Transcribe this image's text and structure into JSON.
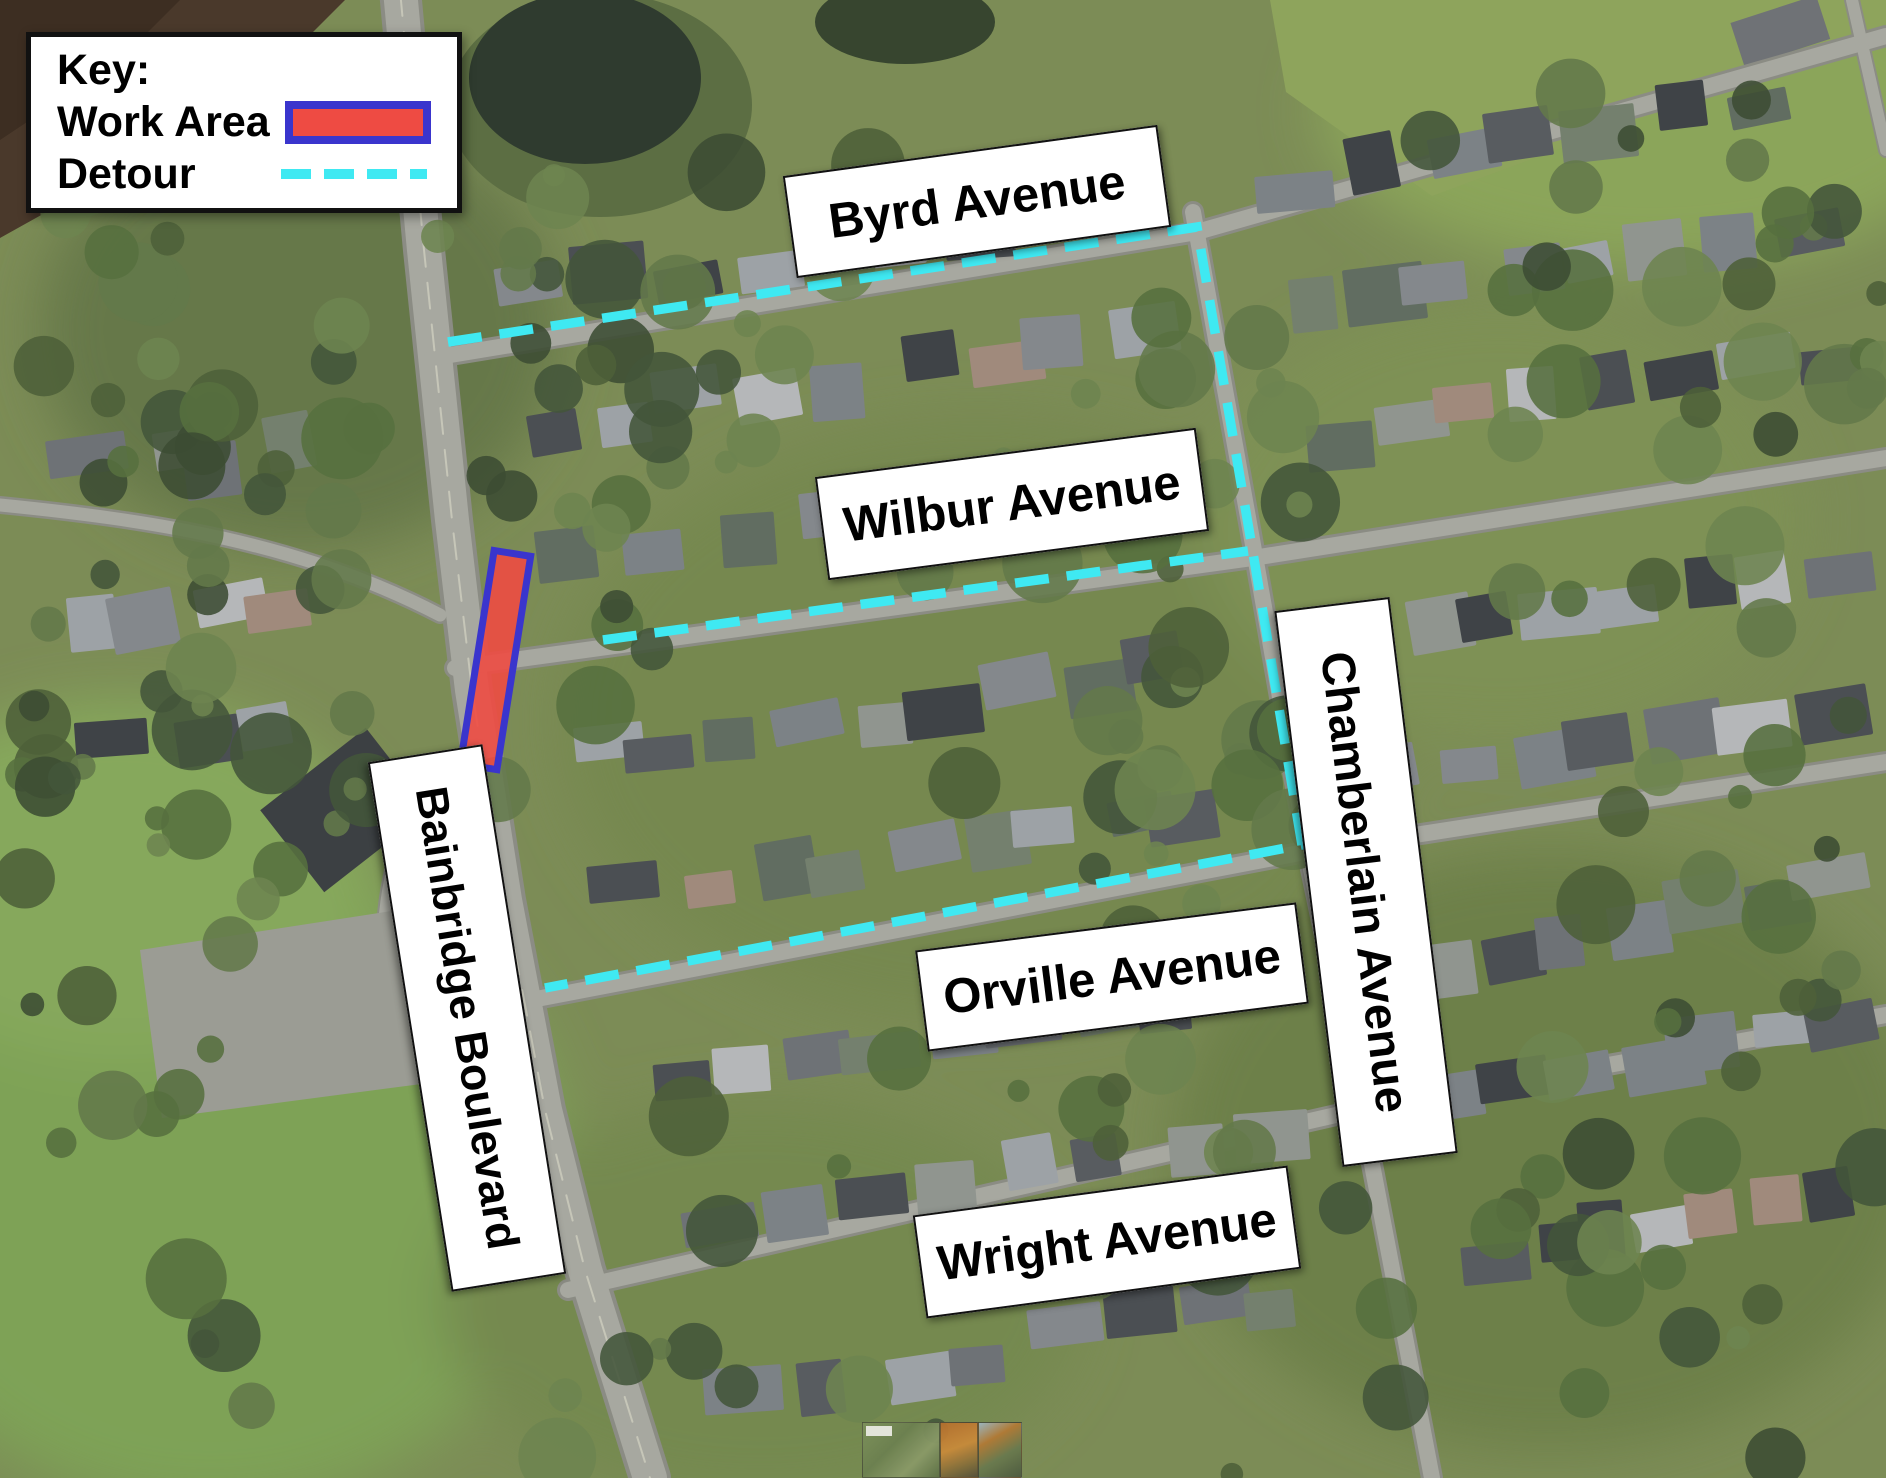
{
  "legend": {
    "title": "Key:",
    "items": [
      {
        "label": "Work Area",
        "swatch": "work-area-swatch"
      },
      {
        "label": "Detour",
        "swatch": "detour-swatch"
      }
    ]
  },
  "streets": {
    "byrd": "Byrd Avenue",
    "wilbur": "Wilbur Avenue",
    "orville": "Orville Avenue",
    "wright": "Wright Avenue",
    "chamberlain": "Chamberlain Avenue",
    "bainbridge": "Bainbridge Boulevard"
  },
  "colors": {
    "work_area_fill": "#ee4b43",
    "work_area_border": "#3a35cd",
    "detour": "#3fe9f2",
    "label_bg": "#ffffff",
    "label_border": "#111111",
    "label_text": "#000000",
    "legend_bg": "#ffffff",
    "legend_border": "#111111"
  },
  "overlay": {
    "detour_main_points": "448,342 1197,227 1253,553 1302,845 545,988",
    "detour_wilbur_points": "603,640 1248,551",
    "work_area": {
      "x": "477",
      "y": "552",
      "width": "37",
      "height": "216",
      "transform": "rotate(9 495 660)"
    }
  }
}
